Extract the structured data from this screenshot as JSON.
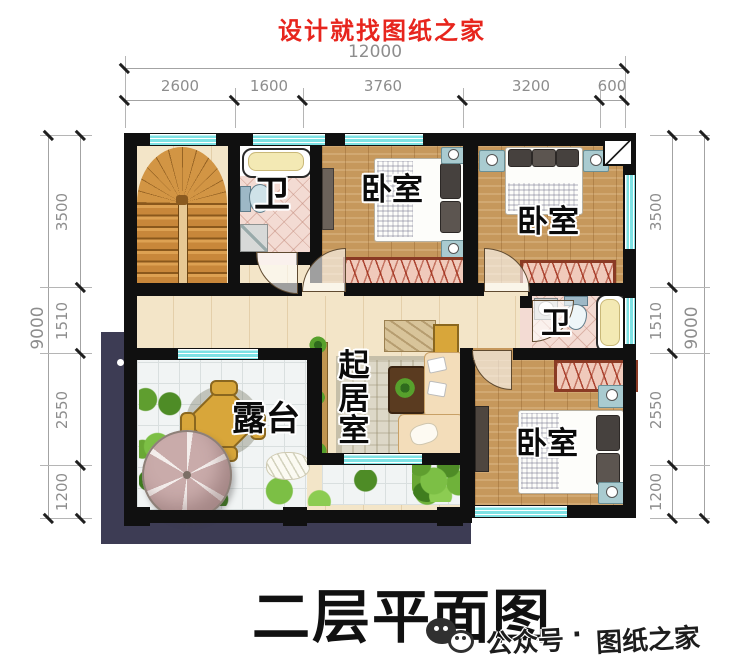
{
  "header": {
    "title": "设计就找图纸之家"
  },
  "dimensions": {
    "top": {
      "total": "12000",
      "segments": [
        "2600",
        "1600",
        "3760",
        "3200",
        "600"
      ]
    },
    "left": {
      "total": "9000",
      "segments": [
        "3500",
        "1510",
        "2550",
        "1200"
      ]
    },
    "right": {
      "total": "9000",
      "segments": [
        "3500",
        "1510",
        "2550",
        "1200"
      ]
    }
  },
  "plan": {
    "rooms": {
      "bathroom_upper": {
        "label": "卫"
      },
      "bedroom_top_middle": {
        "label": "卧室"
      },
      "bedroom_top_right": {
        "label": "卧室"
      },
      "bathroom_middle": {
        "label": "卫"
      },
      "living_room": {
        "label": "起居室"
      },
      "terrace": {
        "label": "露台"
      },
      "bedroom_bottom_right": {
        "label": "卧室"
      }
    }
  },
  "footer": {
    "title": "二层平面图",
    "wechat_icon": "wechat-icon",
    "wechat_label": "公众号",
    "separator": "·",
    "brand": "图纸之家"
  },
  "colors": {
    "accent_red": "#e7251d",
    "wall_black": "#101010",
    "window_cyan": "#7ee2e4",
    "roof_navy": "#3d3c54",
    "bedroom_wood": "#c6985c",
    "hall_cream": "#f3e5c8",
    "bath_pink": "#f3dbd3",
    "wardrobe_red": "#8a3a24",
    "greenery_green": "#6cae3a",
    "dimension_gray": "#8d8d8d"
  }
}
